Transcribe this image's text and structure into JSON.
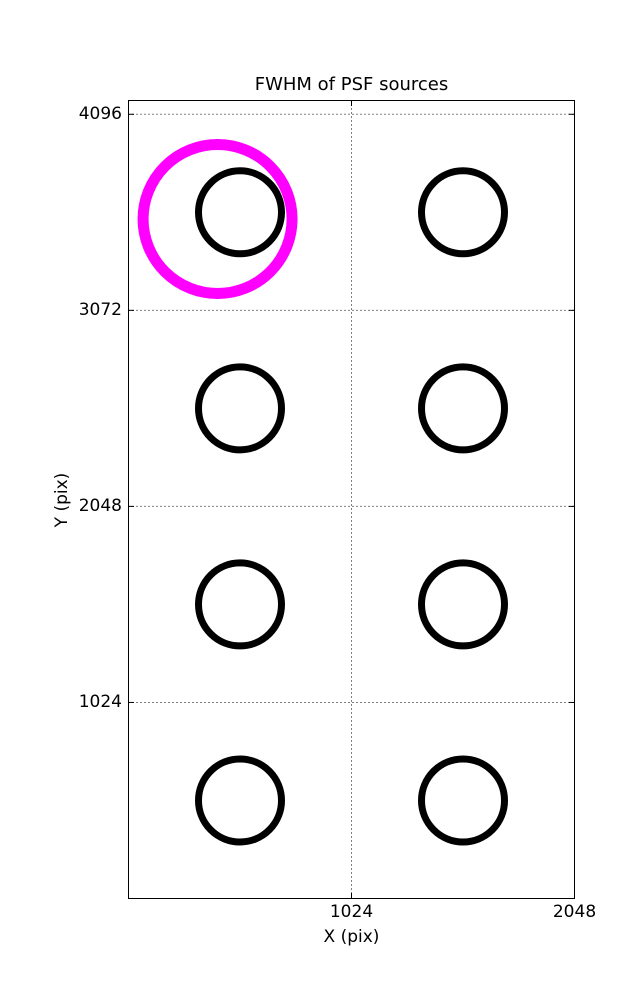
{
  "chart_data": {
    "type": "scatter",
    "title": "FWHM of PSF sources",
    "xlabel": "X (pix)",
    "ylabel": "Y (pix)",
    "xlim": [
      0,
      2048
    ],
    "ylim": [
      0,
      4168
    ],
    "xticks": [
      {
        "value": 1024,
        "label": "1024"
      },
      {
        "value": 2048,
        "label": "2048"
      }
    ],
    "yticks": [
      {
        "value": 1024,
        "label": "1024"
      },
      {
        "value": 2048,
        "label": "2048"
      },
      {
        "value": 3072,
        "label": "3072"
      },
      {
        "value": 4096,
        "label": "4096"
      }
    ],
    "grid": {
      "linestyle": "dotted",
      "color": "#000000",
      "x_values": [
        1024
      ],
      "y_values": [
        1024,
        2048,
        3072,
        4096
      ]
    },
    "legend": "none",
    "series": [
      {
        "name": "psf-source-fwhm-markers",
        "marker": "open-circle",
        "color": "#000000",
        "radius_px": 41.5,
        "stroke_px": 7,
        "points": [
          [
            512,
            3584
          ],
          [
            1536,
            3584
          ],
          [
            512,
            2560
          ],
          [
            1536,
            2560
          ],
          [
            512,
            1536
          ],
          [
            1536,
            1536
          ],
          [
            512,
            512
          ],
          [
            1536,
            512
          ]
        ]
      },
      {
        "name": "highlighted-source-marker",
        "marker": "open-circle",
        "color": "#FF00FF",
        "radius_px": 74.5,
        "stroke_px": 11,
        "points": [
          [
            409,
            3549
          ]
        ]
      }
    ]
  },
  "colors": {
    "background": "#FFFFFF",
    "axis": "#000000",
    "text": "#000000",
    "marker": "#000000",
    "highlight": "#FF00FF"
  }
}
